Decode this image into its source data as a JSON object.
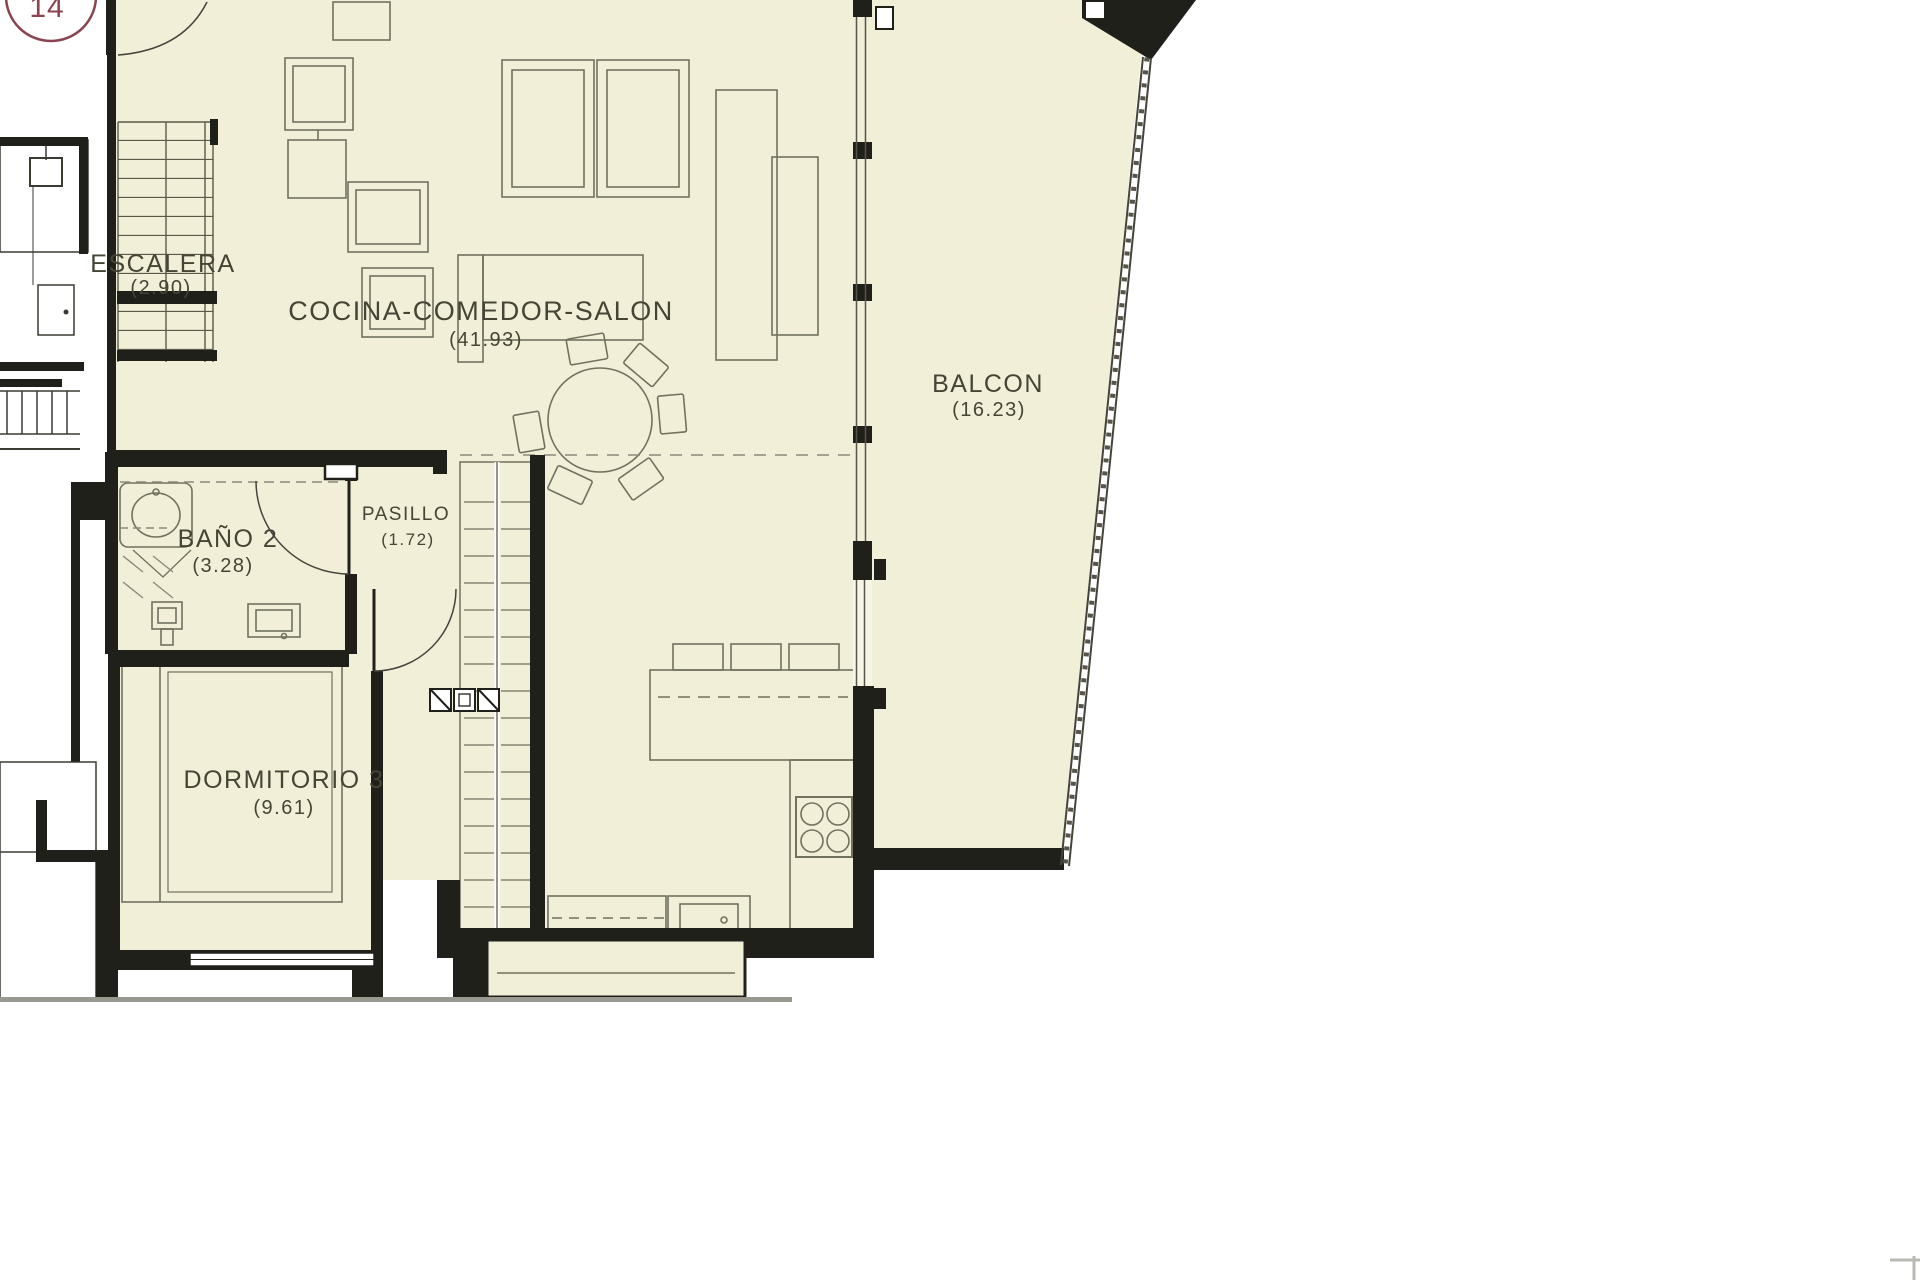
{
  "plan": {
    "unit_badge": "14",
    "rooms": [
      {
        "name": "ESCALERA",
        "area": "(2.90)"
      },
      {
        "name": "COCINA-COMEDOR-SALON",
        "area": "(41.93)"
      },
      {
        "name": "BALCON",
        "area": "(16.23)"
      },
      {
        "name": "BAÑO 2",
        "area": "(3.28)"
      },
      {
        "name": "PASILLO",
        "area": "(1.72)"
      },
      {
        "name": "DORMITORIO 3",
        "area": "(9.61)"
      }
    ],
    "colors": {
      "floor": "#f2efd9",
      "wall": "#20201a",
      "furniture": "#71715f",
      "badge": "#8c4350",
      "label": "#454536"
    }
  }
}
